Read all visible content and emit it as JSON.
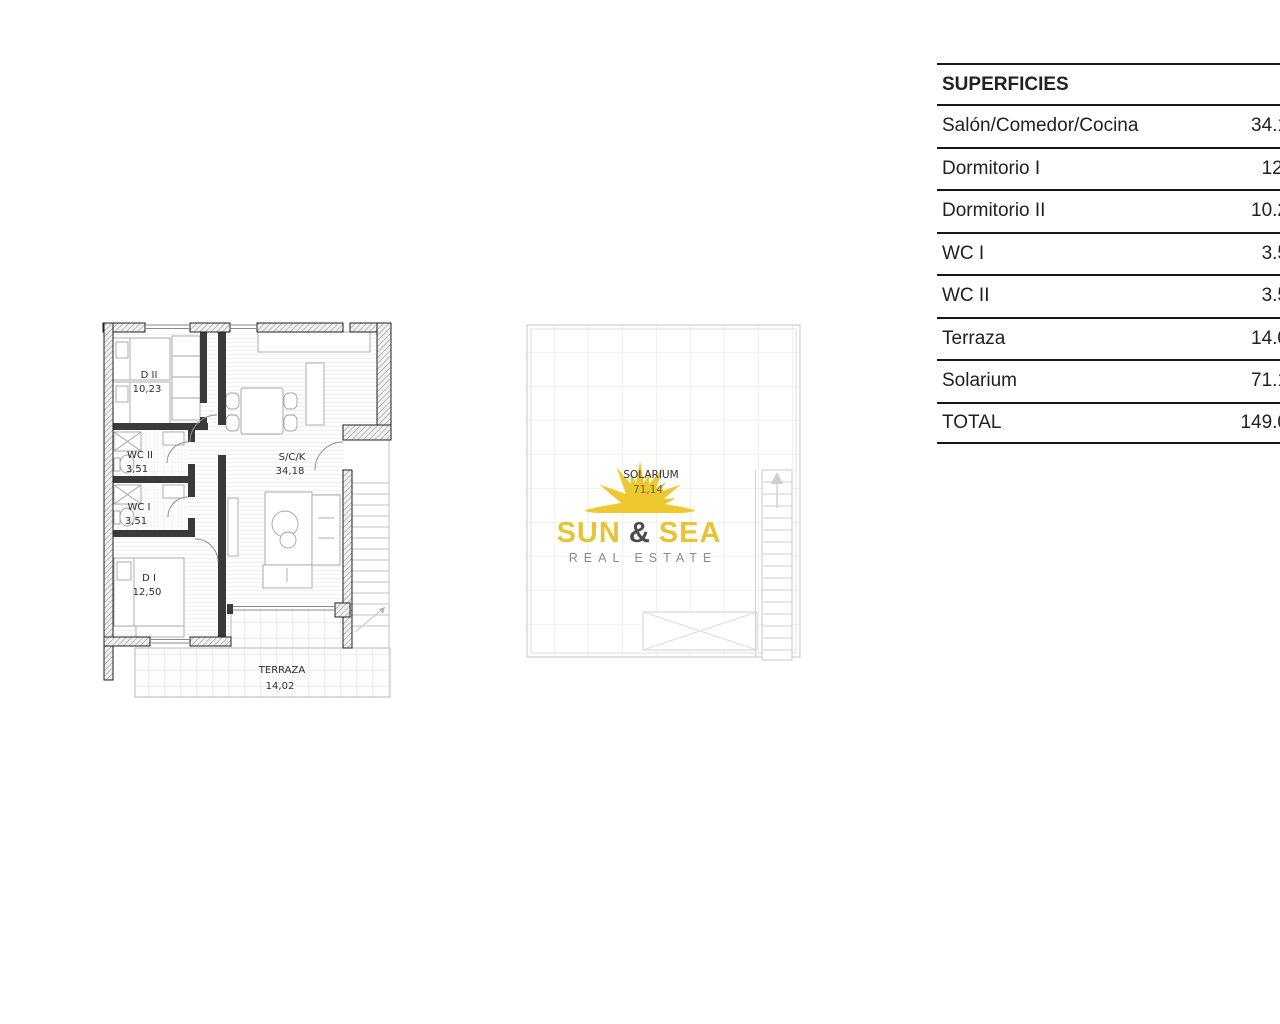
{
  "superficies_table": {
    "header": "SUPERFICIES",
    "rows": [
      {
        "label": "Salón/Comedor/Cocina",
        "value_visible": "34.1"
      },
      {
        "label": "Dormitorio I",
        "value_visible": "12."
      },
      {
        "label": "Dormitorio II",
        "value_visible": "10.2"
      },
      {
        "label": "WC I",
        "value_visible": "3.5"
      },
      {
        "label": "WC II",
        "value_visible": "3.5"
      },
      {
        "label": "Terraza",
        "value_visible": "14.0"
      },
      {
        "label": "Solarium",
        "value_visible": "71.1"
      },
      {
        "label": "TOTAL",
        "value_visible": "149.0"
      }
    ]
  },
  "apartment_plan": {
    "rooms": {
      "d2": {
        "name": "D II",
        "area": "10,23"
      },
      "wc2": {
        "name": "WC II",
        "area": "3,51"
      },
      "wc1": {
        "name": "WC I",
        "area": "3,51"
      },
      "d1": {
        "name": "D I",
        "area": "12,50"
      },
      "sck": {
        "name": "S/C/K",
        "area": "34,18"
      },
      "terraza": {
        "name": "TERRAZA",
        "area": "14,02"
      }
    }
  },
  "solarium_plan": {
    "room": {
      "name": "SOLARIUM",
      "area": "71,14"
    }
  },
  "logo": {
    "word1": "SUN",
    "ampersand": "&",
    "word2": "SEA",
    "subtitle": "REAL ESTATE",
    "colors": {
      "gold": "#E7C435",
      "dark": "#4B4B50",
      "gray": "#8C8C8C",
      "sun": "#EEC82F"
    }
  }
}
